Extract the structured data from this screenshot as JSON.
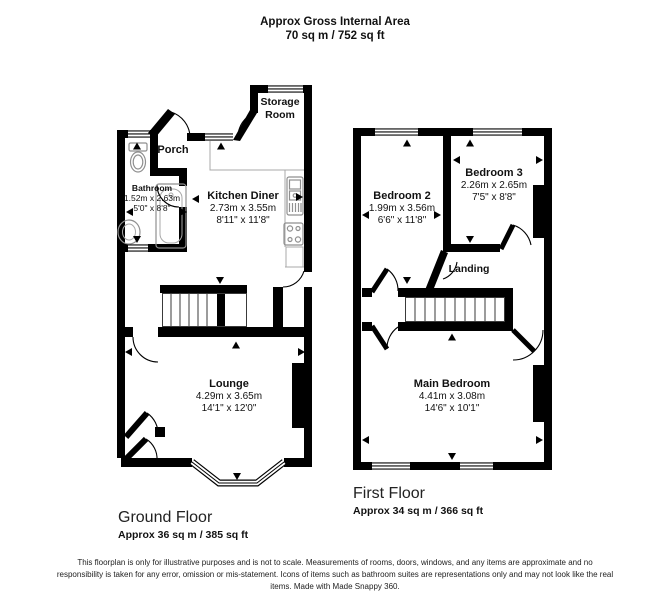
{
  "header": {
    "title": "Approx Gross Internal Area",
    "subtitle": "70 sq m / 752 sq ft"
  },
  "ground_floor": {
    "caption": "Ground Floor",
    "area": "Approx 36 sq m / 385 sq ft",
    "rooms": {
      "storage_room": {
        "name": "Storage Room"
      },
      "porch": {
        "name": "Porch"
      },
      "bathroom": {
        "name": "Bathroom",
        "metric": "1.52m x 2.63m",
        "imperial": "5'0\" x 8'8\""
      },
      "kitchen_diner": {
        "name": "Kitchen Diner",
        "metric": "2.73m x 3.55m",
        "imperial": "8'11\" x 11'8\""
      },
      "lounge": {
        "name": "Lounge",
        "metric": "4.29m x 3.65m",
        "imperial": "14'1\" x 12'0\""
      }
    }
  },
  "first_floor": {
    "caption": "First Floor",
    "area": "Approx 34 sq m / 366 sq ft",
    "rooms": {
      "bedroom_2": {
        "name": "Bedroom 2",
        "metric": "1.99m x 3.56m",
        "imperial": "6'6\" x 11'8\""
      },
      "bedroom_3": {
        "name": "Bedroom 3",
        "metric": "2.26m x 2.65m",
        "imperial": "7'5\" x 8'8\""
      },
      "landing": {
        "name": "Landing"
      },
      "main_bedroom": {
        "name": "Main Bedroom",
        "metric": "4.41m x 3.08m",
        "imperial": "14'6\" x 10'1\""
      }
    }
  },
  "footer": {
    "disclaimer": "This floorplan is only for illustrative purposes and is not to scale. Measurements of rooms, doors, windows, and any items are approximate and no responsibility is taken for any error, omission or mis-statement. Icons of items such as bathroom suites are representations only and may not look like the real items. Made with Made Snappy 360."
  },
  "colors": {
    "wall": "#000000",
    "background": "#ffffff",
    "fixture_gray": "#8f8f8f"
  }
}
